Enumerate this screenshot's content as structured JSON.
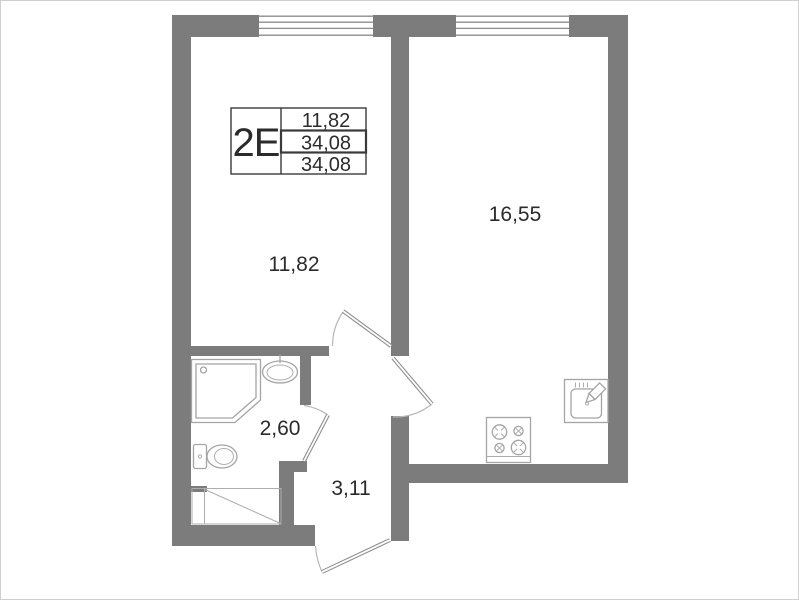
{
  "plan": {
    "title_block": {
      "type": "2E",
      "values": [
        "11,82",
        "34,08",
        "34,08"
      ]
    },
    "rooms": [
      {
        "id": "living-room",
        "area": "11,82"
      },
      {
        "id": "kitchen-living",
        "area": "16,55"
      },
      {
        "id": "bathroom",
        "area": "2,60"
      },
      {
        "id": "hallway",
        "area": "3,11"
      }
    ],
    "colors": {
      "wall": "#7c7c7c",
      "window_line": "#8c8c8c",
      "fixture_line": "#a4a4a4",
      "door_arc": "#b8b8b8",
      "text": "#2b2b2b"
    }
  }
}
